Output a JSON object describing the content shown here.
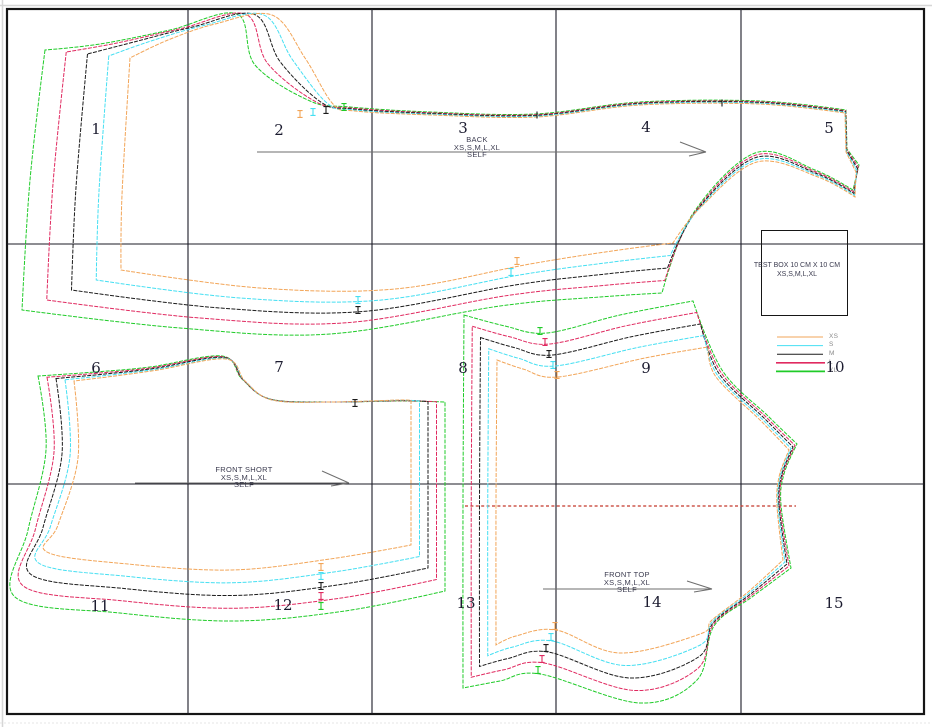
{
  "pages": {
    "labels": [
      "1",
      "2",
      "3",
      "4",
      "5",
      "6",
      "7",
      "8",
      "9",
      "10",
      "11",
      "12",
      "13",
      "14",
      "15"
    ]
  },
  "pieces": {
    "back": {
      "name": "BACK",
      "sizes": "XS,S,M,L,XL",
      "fabric": "SELF"
    },
    "front_short": {
      "name": "FRONT SHORT",
      "sizes": "XS,S,M,L,XL",
      "fabric": "SELF"
    },
    "front_top": {
      "name": "FRONT TOP",
      "sizes": "XS,S,M,L,XL",
      "fabric": "SELF"
    }
  },
  "test_box": {
    "line1": "TEST BOX 10 CM X 10 CM",
    "line2": "XS,S,M,L,XL"
  },
  "legend": {
    "sizes": [
      {
        "label": "XS",
        "color": "#f2a558"
      },
      {
        "label": "S",
        "color": "#45dff2"
      },
      {
        "label": "M",
        "color": "#1b1b1b"
      },
      {
        "label": "L",
        "color": "#e02a60"
      },
      {
        "label": "XL",
        "color": "#1fcb28"
      }
    ]
  },
  "colors": {
    "grid": "#1b1b26",
    "border": "#151515",
    "grainline": "#6e6e6e",
    "lengthen_line": "#c4372a",
    "label_text": "#3c3c50",
    "page_number": "#1c1c30",
    "legend_label": "#8a8a8a",
    "window_edge": "#d6d6d6"
  }
}
